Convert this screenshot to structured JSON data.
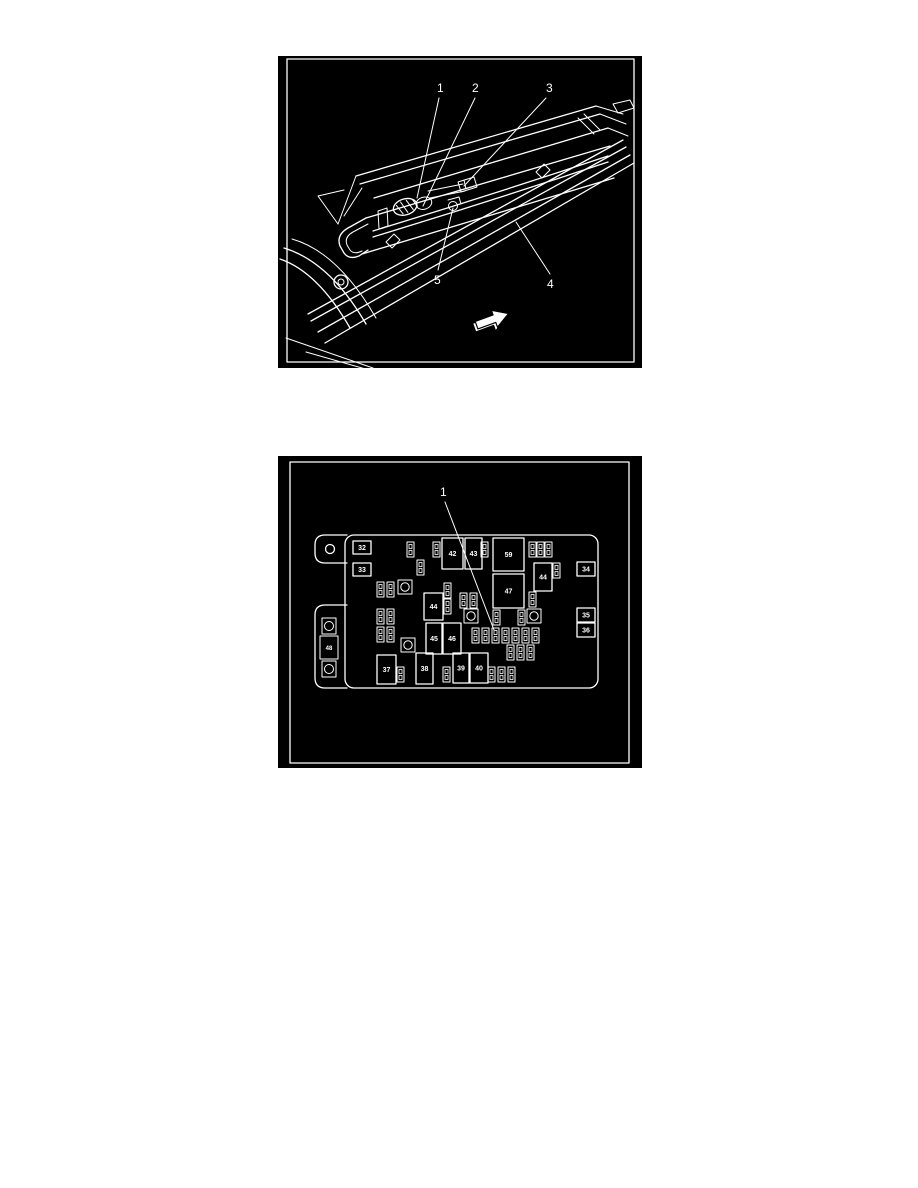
{
  "page": {
    "background_color": "#ffffff",
    "figure_background_color": "#000000",
    "line_color": "#ffffff"
  },
  "figure1": {
    "name": "underbody-line-routing-view",
    "callouts": [
      {
        "label": "1",
        "tx": 159,
        "ty": 36,
        "lx1": 161,
        "ly1": 42,
        "lx2": 139,
        "ly2": 142
      },
      {
        "label": "2",
        "tx": 194,
        "ty": 36,
        "lx1": 197,
        "ly1": 42,
        "lx2": 145,
        "ly2": 150
      },
      {
        "label": "3",
        "tx": 268,
        "ty": 36,
        "lx1": 268,
        "ly1": 42,
        "lx2": 186,
        "ly2": 130
      },
      {
        "label": "5",
        "tx": 156,
        "ty": 228,
        "lx1": 160,
        "ly1": 214,
        "lx2": 175,
        "ly2": 152
      },
      {
        "label": "4",
        "tx": 269,
        "ty": 232,
        "lx1": 272,
        "ly1": 218,
        "lx2": 238,
        "ly2": 166
      }
    ],
    "direction_arrow": "forward-direction-arrow"
  },
  "figure2": {
    "name": "fuse-block-view",
    "callout": {
      "label": "1",
      "tx": 162,
      "ty": 40,
      "lx1": 167,
      "ly1": 46,
      "lx2": 216,
      "ly2": 174
    },
    "mega_fuse": {
      "label": "48"
    },
    "labeled_fuses": [
      {
        "label": "32",
        "x": 75,
        "y": 85,
        "w": 18,
        "h": 13
      },
      {
        "label": "33",
        "x": 75,
        "y": 107,
        "w": 18,
        "h": 13
      },
      {
        "label": "42",
        "x": 164,
        "y": 82,
        "w": 21,
        "h": 31
      },
      {
        "label": "43",
        "x": 187,
        "y": 82,
        "w": 17,
        "h": 31
      },
      {
        "label": "59",
        "x": 215,
        "y": 82,
        "w": 31,
        "h": 33
      },
      {
        "label": "44",
        "x": 256,
        "y": 107,
        "w": 18,
        "h": 28
      },
      {
        "label": "34",
        "x": 299,
        "y": 106,
        "w": 18,
        "h": 14
      },
      {
        "label": "47",
        "x": 215,
        "y": 118,
        "w": 31,
        "h": 34
      },
      {
        "label": "35",
        "x": 299,
        "y": 152,
        "w": 18,
        "h": 14
      },
      {
        "label": "36",
        "x": 299,
        "y": 167,
        "w": 18,
        "h": 14
      },
      {
        "label": "44",
        "x": 146,
        "y": 137,
        "w": 19,
        "h": 27
      },
      {
        "label": "45",
        "x": 148,
        "y": 167,
        "w": 16,
        "h": 31
      },
      {
        "label": "46",
        "x": 165,
        "y": 167,
        "w": 18,
        "h": 31
      },
      {
        "label": "37",
        "x": 99,
        "y": 199,
        "w": 19,
        "h": 29
      },
      {
        "label": "38",
        "x": 138,
        "y": 197,
        "w": 17,
        "h": 31
      },
      {
        "label": "39",
        "x": 175,
        "y": 197,
        "w": 16,
        "h": 30
      },
      {
        "label": "40",
        "x": 192,
        "y": 197,
        "w": 18,
        "h": 30
      }
    ],
    "small_fuses": [
      [
        129,
        86
      ],
      [
        139,
        104
      ],
      [
        155,
        86
      ],
      [
        203,
        86
      ],
      [
        251,
        86
      ],
      [
        259,
        86
      ],
      [
        267,
        86
      ],
      [
        275,
        107
      ],
      [
        251,
        136
      ],
      [
        99,
        126
      ],
      [
        109,
        126
      ],
      [
        99,
        153
      ],
      [
        109,
        153
      ],
      [
        99,
        171
      ],
      [
        109,
        171
      ],
      [
        166,
        127
      ],
      [
        166,
        143
      ],
      [
        182,
        137
      ],
      [
        192,
        137
      ],
      [
        215,
        154
      ],
      [
        240,
        154
      ],
      [
        194,
        172
      ],
      [
        204,
        172
      ],
      [
        214,
        172
      ],
      [
        224,
        172
      ],
      [
        234,
        172
      ],
      [
        244,
        172
      ],
      [
        254,
        172
      ],
      [
        229,
        189
      ],
      [
        239,
        189
      ],
      [
        249,
        189
      ],
      [
        210,
        211
      ],
      [
        220,
        211
      ],
      [
        230,
        211
      ],
      [
        119,
        211
      ],
      [
        165,
        211
      ]
    ],
    "studs": [
      [
        120,
        124
      ],
      [
        186,
        153
      ],
      [
        249,
        153
      ],
      [
        123,
        182
      ]
    ]
  }
}
